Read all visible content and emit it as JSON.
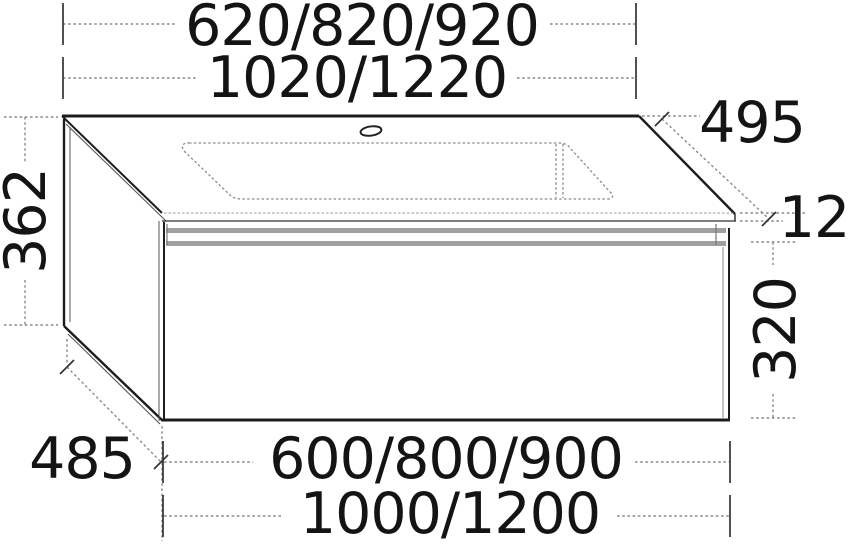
{
  "drawing": {
    "title_hint": "vanity unit with washbasin dimension drawing",
    "dimensions": {
      "basin_widths": "620/820/920",
      "countertop_widths": "1020/1220",
      "countertop_depth": "495",
      "total_height": "362",
      "countertop_thickness": "12",
      "cabinet_height": "320",
      "cabinet_depth": "485",
      "cabinet_widths": "600/800/900",
      "overall_widths": "1000/1200"
    },
    "colors": {
      "outline": "#1c1c1c",
      "secondary_line": "#555555",
      "dimension_line": "#8a8a8a",
      "tick": "#333333",
      "shade_band": "#a0a0a0",
      "text": "#141414",
      "background": "#ffffff"
    }
  }
}
